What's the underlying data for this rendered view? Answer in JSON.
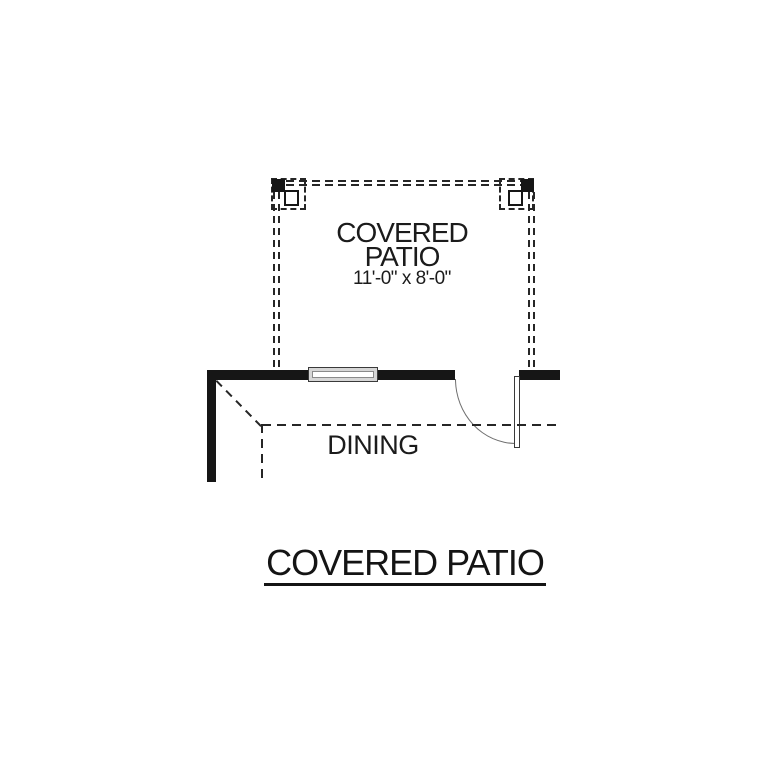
{
  "labels": {
    "patio_line1": "COVERED",
    "patio_line2": "PATIO",
    "patio_dims": "11'-0\" x 8'-0\"",
    "room": "DINING",
    "sheet_title": "COVERED PATIO"
  },
  "colors": {
    "background": "#ffffff",
    "wall": "#161616",
    "dash": "#262626",
    "arc": "#6e6e6e",
    "window_fill": "#d6d6d6"
  }
}
